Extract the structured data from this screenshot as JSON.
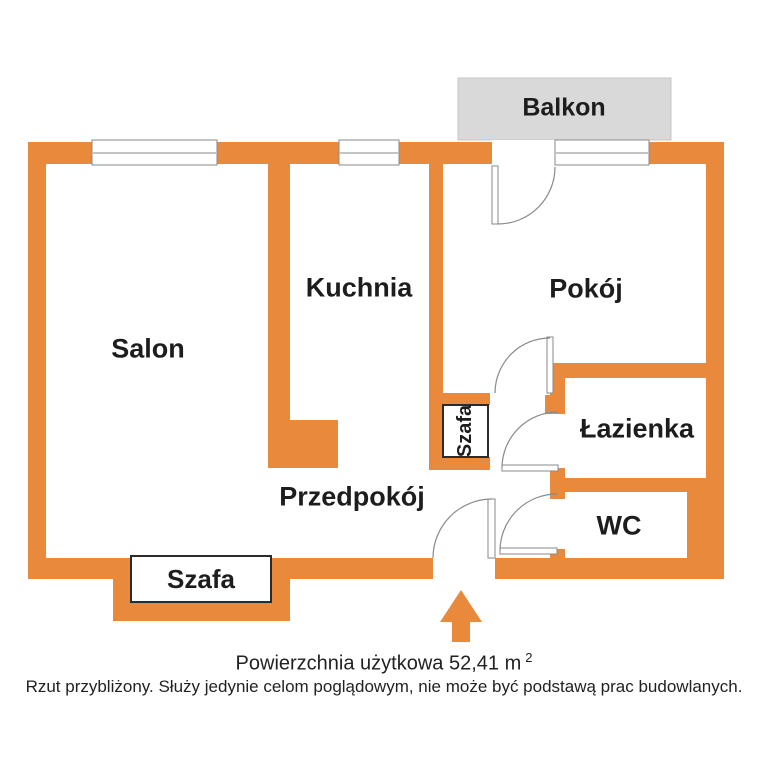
{
  "colors": {
    "wall_orange": "#E8893C",
    "balcony_gray": "#D9D9D9",
    "text_black": "#1d1d1d"
  },
  "balcony": {
    "label": "Balkon"
  },
  "rooms": {
    "salon": {
      "label": "Salon"
    },
    "kuchnia": {
      "label": "Kuchnia"
    },
    "pokoj": {
      "label": "Pokój"
    },
    "przedpokoj": {
      "label": "Przedpokój"
    },
    "lazienka": {
      "label": "Łazienka"
    },
    "wc": {
      "label": "WC"
    }
  },
  "closets": {
    "hall_label": "Szafa",
    "salon_label": "Szafa"
  },
  "footer": {
    "area_text": "Powierzchnia użytkowa 52,41 m",
    "area_superscript": "2",
    "disclaimer": "Rzut przybliżony. Służy jedynie celom poglądowym, nie może być podstawą prac budowlanych."
  }
}
